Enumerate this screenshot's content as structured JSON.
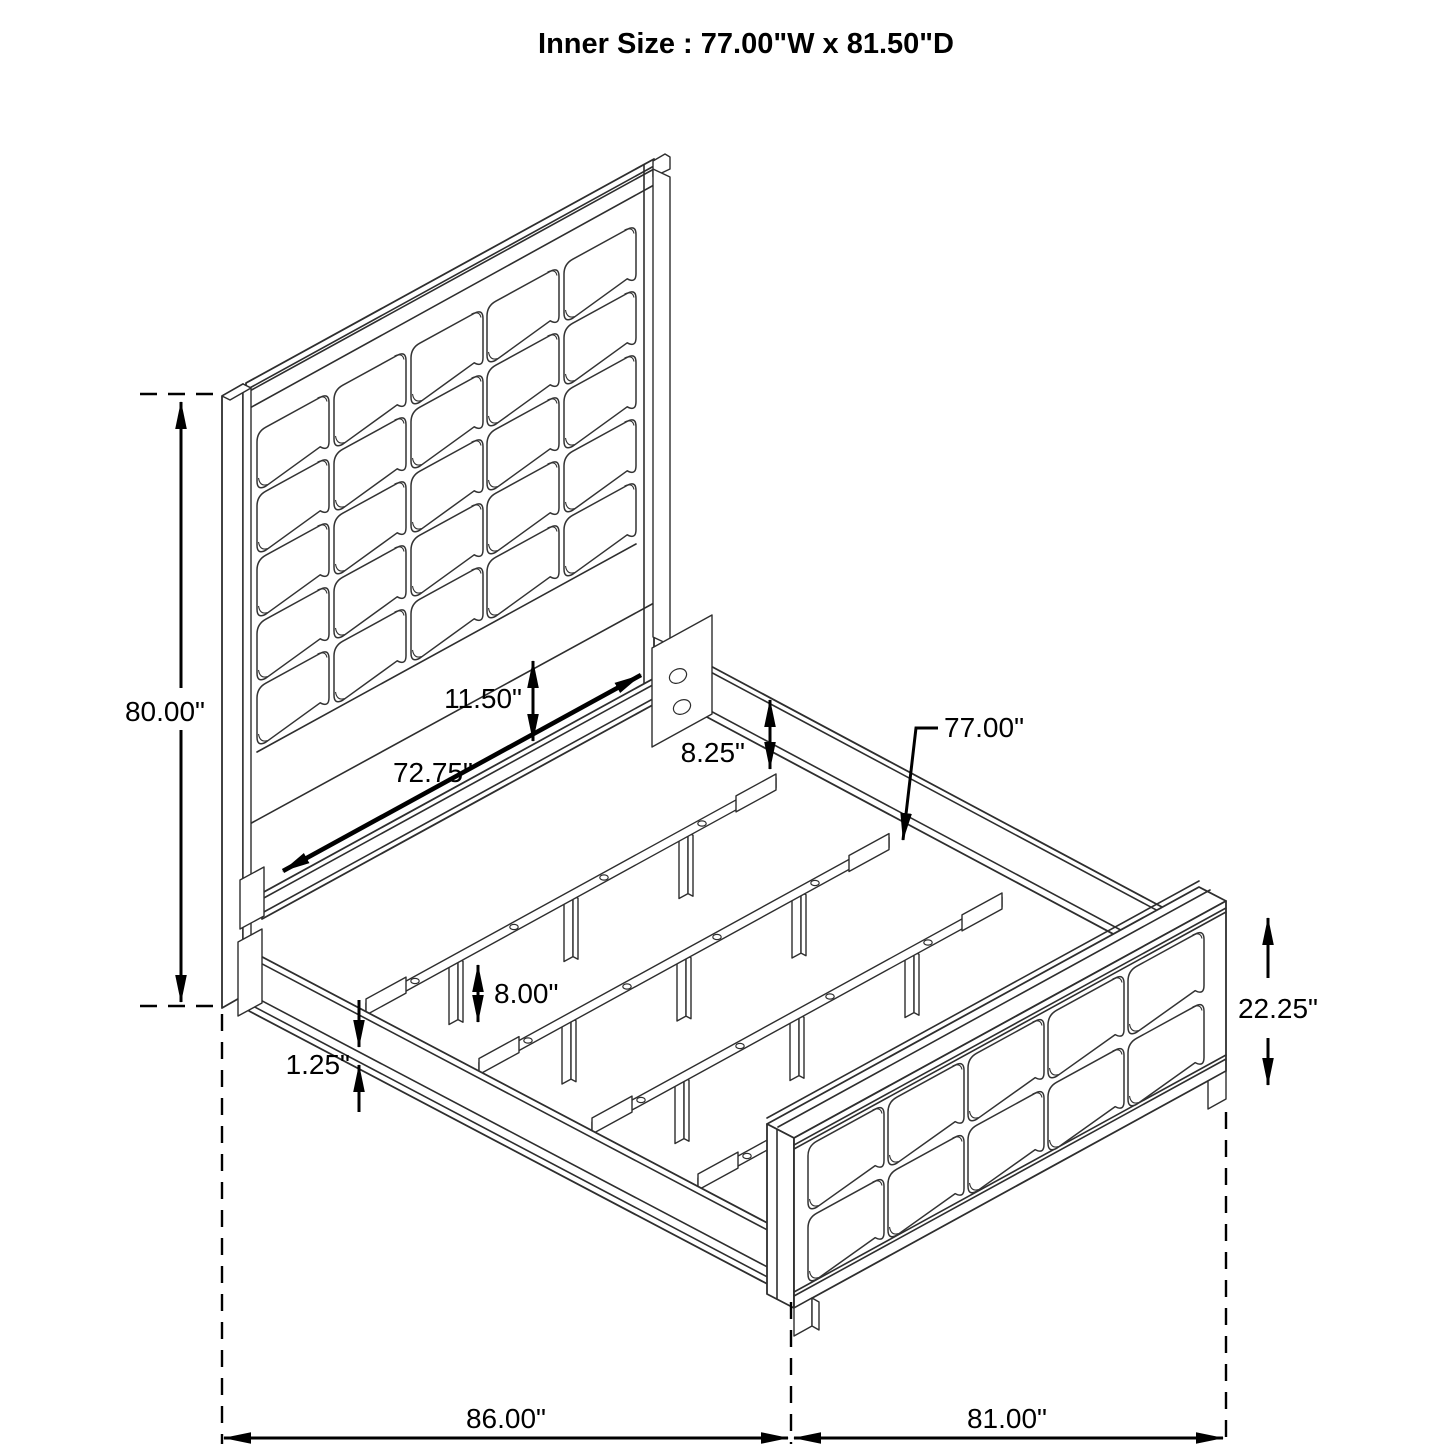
{
  "diagram": {
    "title": "Inner Size : 77.00\"W x 81.50\"D",
    "type": "bed-frame-dimension-drawing",
    "dimensions": {
      "headboard_height": "80.00\"",
      "headboard_lower_panel": "11.50\"",
      "head_rail_length": "72.75\"",
      "rail_top_to_slat": "8.25\"",
      "slat_length": "77.00\"",
      "slat_leg_height": "8.00\"",
      "side_rail_lip": "1.25\"",
      "footboard_height": "22.25\"",
      "overall_length": "86.00\"",
      "overall_width": "81.00\""
    },
    "colors": {
      "background": "#ffffff",
      "structure_line": "#2e2e2e",
      "dimension_line": "#000000",
      "text": "#000000"
    }
  }
}
